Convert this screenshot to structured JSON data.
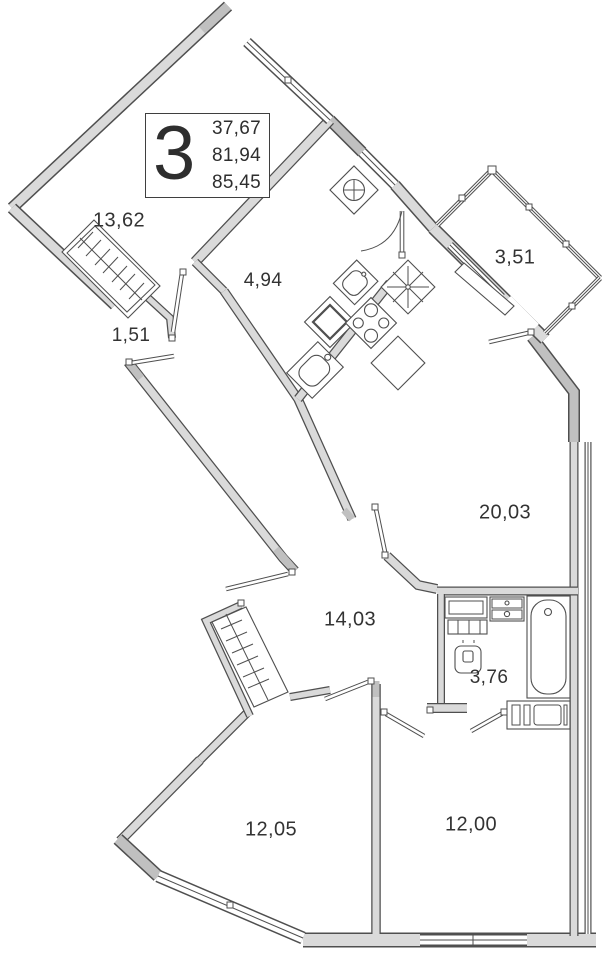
{
  "title": "Apartment floor plan",
  "unit": {
    "rooms_count": "3",
    "area_living": "37,67",
    "area_main": "81,94",
    "area_total": "85,45"
  },
  "rooms": [
    {
      "name": "room",
      "area": "13,62"
    },
    {
      "name": "hall-wardrobe",
      "area": "1,51"
    },
    {
      "name": "bathroom",
      "area": "4,94"
    },
    {
      "name": "balcony",
      "area": "3,51"
    },
    {
      "name": "kitchen-living",
      "area": "20,03"
    },
    {
      "name": "corridor",
      "area": "14,03"
    },
    {
      "name": "wc",
      "area": "3,76"
    },
    {
      "name": "bedroom-left",
      "area": "12,05"
    },
    {
      "name": "bedroom-right",
      "area": "12,00"
    }
  ],
  "colors": {
    "wall_light": "#dadada",
    "wall_dark": "#c0c0c0",
    "outline": "#4f4f4f",
    "text": "#333333",
    "background": "#ffffff"
  }
}
